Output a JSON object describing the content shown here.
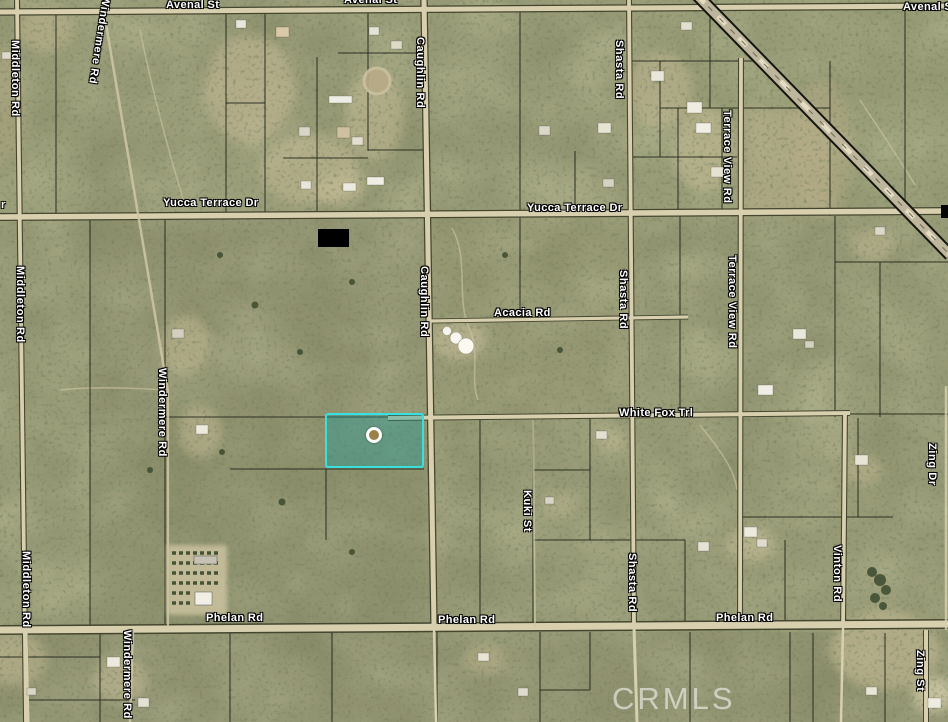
{
  "map": {
    "type": "satellite-aerial-parcel-map",
    "watermark": "CRMLS",
    "colors": {
      "terrain_base": "#8d906c",
      "road_fill": "#d7cfae",
      "parcel_line": "#20231a",
      "label_text": "#ffffff",
      "highlight_border": "#38e0e0",
      "highlight_fill": "rgba(26,158,158,0.38)",
      "marker_fill": "#9a8148",
      "watermark_color": "rgba(255,255,255,0.55)"
    },
    "highlighted_parcel": {
      "marker": "circle-marker"
    },
    "labels": [
      {
        "text": "Avenal St",
        "x": 166,
        "y": -1
      },
      {
        "text": "Avenal St",
        "x": 344,
        "y": -6
      },
      {
        "text": "Avenal St",
        "x": 903,
        "y": 1
      },
      {
        "text": "Yucca Terrace Dr",
        "x": 163,
        "y": 197
      },
      {
        "text": "Yucca Terrace Dr",
        "x": 527,
        "y": 202
      },
      {
        "text": "r",
        "x": 1,
        "y": 199
      },
      {
        "text": "Acacia Rd",
        "x": 494,
        "y": 307
      },
      {
        "text": "White Fox Trl",
        "x": 619,
        "y": 407
      },
      {
        "text": "Phelan Rd",
        "x": 206,
        "y": 612
      },
      {
        "text": "Phelan Rd",
        "x": 438,
        "y": 614
      },
      {
        "text": "Phelan Rd",
        "x": 716,
        "y": 612
      },
      {
        "text": "Middleton Rd",
        "x": 9,
        "y": 40,
        "v": true
      },
      {
        "text": "Middleton Rd",
        "x": 14,
        "y": 266,
        "v": true
      },
      {
        "text": "Middleton Rd",
        "x": 20,
        "y": 551,
        "v": true
      },
      {
        "text": "Windermere Rd",
        "x": 100,
        "y": -4,
        "v": true,
        "rot": 9
      },
      {
        "text": "Windermere Rd",
        "x": 156,
        "y": 368,
        "v": true
      },
      {
        "text": "Windermere Rd",
        "x": 121,
        "y": 630,
        "v": true
      },
      {
        "text": "Caughlin Rd",
        "x": 414,
        "y": 37,
        "v": true
      },
      {
        "text": "Caughlin Rd",
        "x": 418,
        "y": 266,
        "v": true
      },
      {
        "text": "Shasta Rd",
        "x": 613,
        "y": 40,
        "v": true
      },
      {
        "text": "Shasta Rd",
        "x": 617,
        "y": 270,
        "v": true
      },
      {
        "text": "Shasta Rd",
        "x": 626,
        "y": 553,
        "v": true
      },
      {
        "text": "Terrace View Rd",
        "x": 721,
        "y": 110,
        "v": true
      },
      {
        "text": "Terrace View Rd",
        "x": 726,
        "y": 255,
        "v": true
      },
      {
        "text": "Kuki St",
        "x": 521,
        "y": 490,
        "v": true
      },
      {
        "text": "Vinton Rd",
        "x": 831,
        "y": 545,
        "v": true
      },
      {
        "text": "Zing Dr",
        "x": 926,
        "y": 443,
        "v": true
      },
      {
        "text": "Zing St",
        "x": 914,
        "y": 650,
        "v": true
      }
    ]
  }
}
